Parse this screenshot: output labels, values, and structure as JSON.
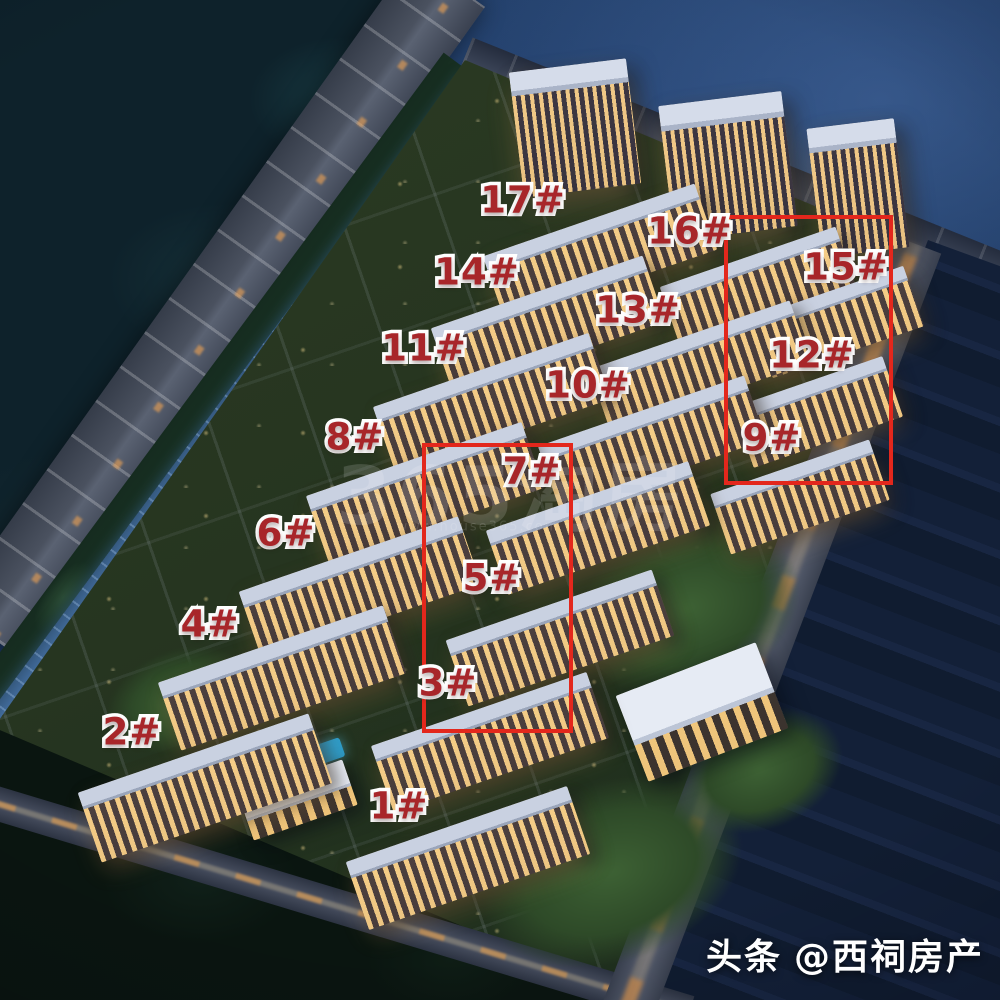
{
  "annotations": {
    "label_red": "#a8262a",
    "box_red": "#e3271c",
    "building_labels": [
      {
        "text": "1#",
        "x": 399,
        "y": 806
      },
      {
        "text": "2#",
        "x": 132,
        "y": 732
      },
      {
        "text": "3#",
        "x": 448,
        "y": 683
      },
      {
        "text": "4#",
        "x": 210,
        "y": 624
      },
      {
        "text": "5#",
        "x": 492,
        "y": 578
      },
      {
        "text": "6#",
        "x": 286,
        "y": 533
      },
      {
        "text": "7#",
        "x": 532,
        "y": 471
      },
      {
        "text": "8#",
        "x": 355,
        "y": 437
      },
      {
        "text": "9#",
        "x": 772,
        "y": 438
      },
      {
        "text": "10#",
        "x": 588,
        "y": 385
      },
      {
        "text": "11#",
        "x": 424,
        "y": 348
      },
      {
        "text": "12#",
        "x": 812,
        "y": 355
      },
      {
        "text": "13#",
        "x": 638,
        "y": 310
      },
      {
        "text": "14#",
        "x": 477,
        "y": 272
      },
      {
        "text": "15#",
        "x": 846,
        "y": 267
      },
      {
        "text": "16#",
        "x": 690,
        "y": 231
      },
      {
        "text": "17#",
        "x": 523,
        "y": 200
      }
    ],
    "highlight_boxes": [
      {
        "x": 724,
        "y": 215,
        "w": 161,
        "h": 262
      },
      {
        "x": 422,
        "y": 443,
        "w": 143,
        "h": 282
      }
    ]
  },
  "watermark": {
    "title": "365淘房",
    "url": "www.house365.com"
  },
  "attribution": {
    "source": "头条",
    "handle": "@西祠房产"
  }
}
